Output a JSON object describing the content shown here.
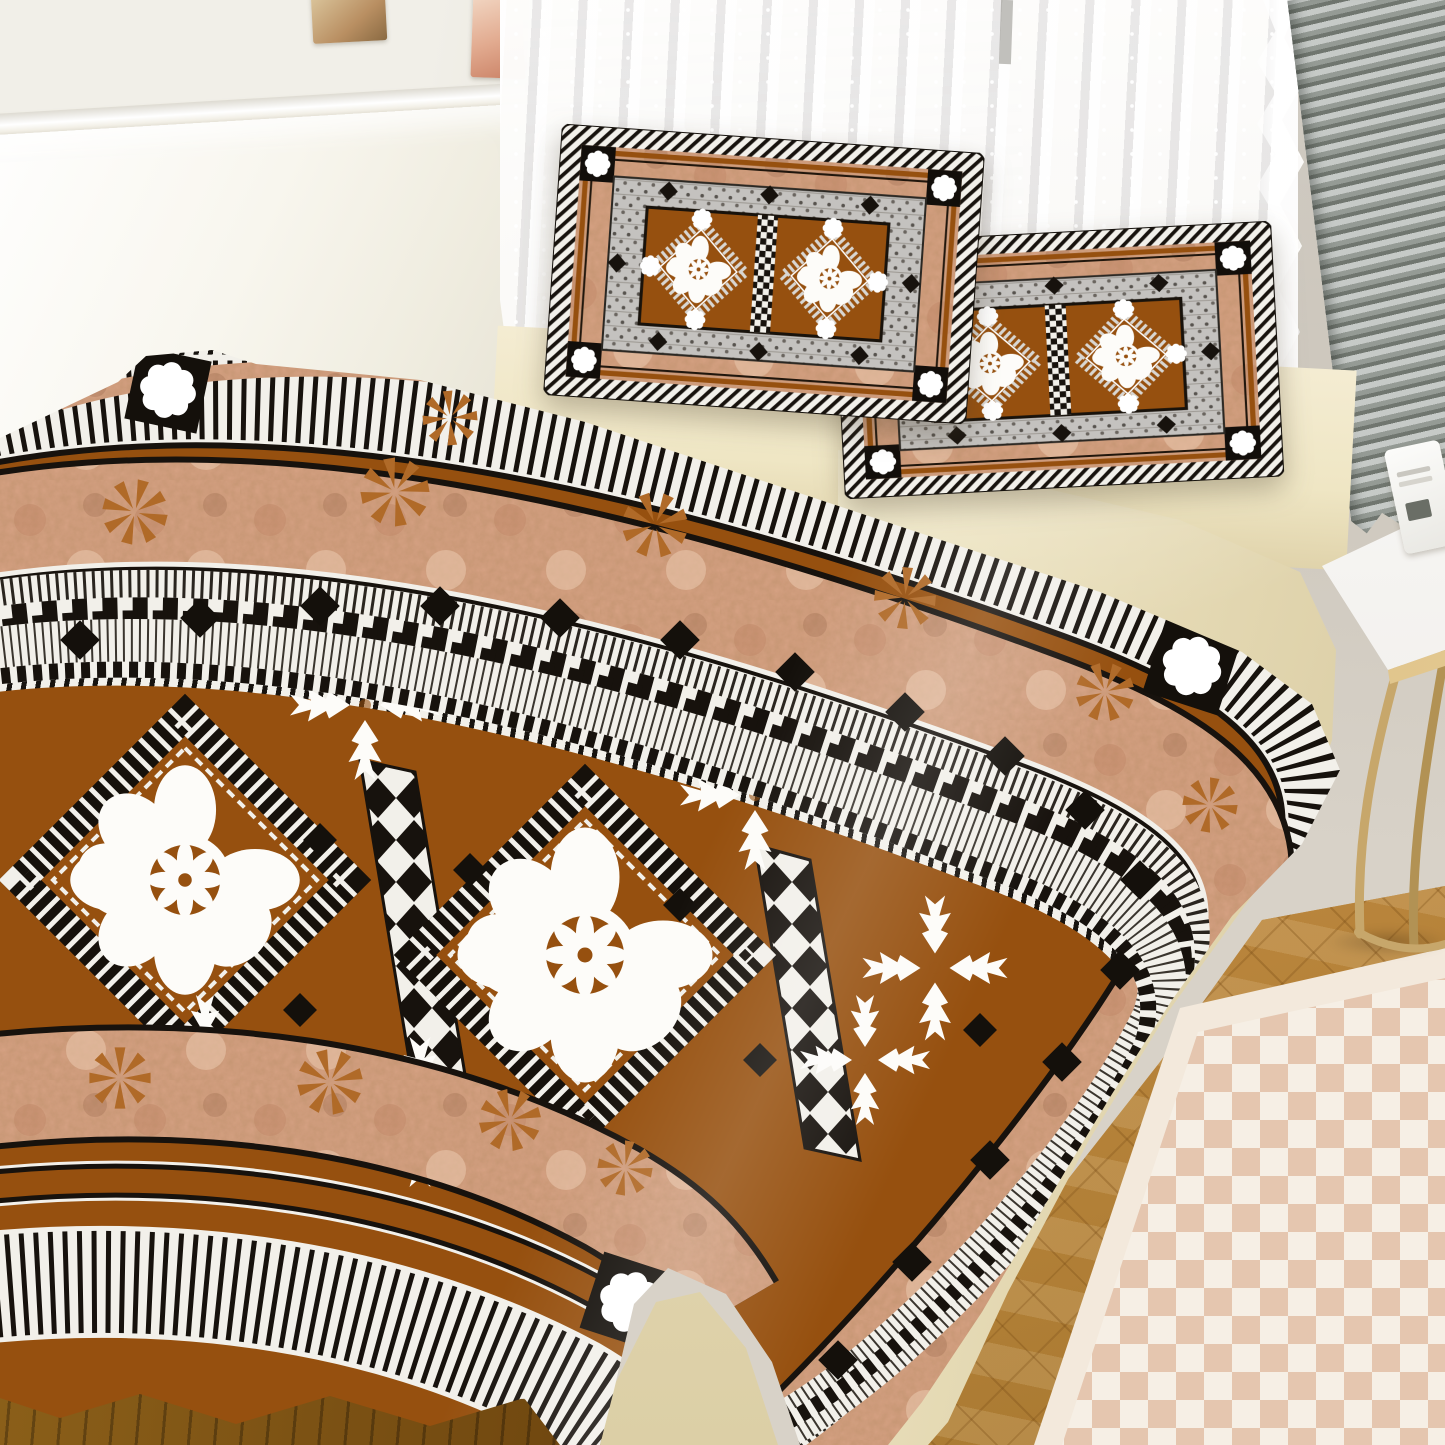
{
  "scene": {
    "type": "photograph",
    "description": "Bedroom product photo of a Fijian tapa-print bedding set: duvet cover and two matching pillowcases in brown, tan, black and white tribal pattern",
    "objects": {
      "wall_left": "white paneled wall with chair-rail molding",
      "photo_cards": "two small art cards pinned on wall",
      "window": "sheer lace curtain over venetian blinds",
      "pleated_blind": "grey pleated blind, top right corner",
      "pillow_left": "tapa-print pillowcase, rear left",
      "pillow_right": "tapa-print pillowcase, front right",
      "duvet": "tapa-print duvet with flower medallion diamonds and striped borders",
      "sheet": "cream bed sheet and mattress",
      "side_table": "white side table with brass legs and small white object",
      "floor": "light oak herringbone floor and dark wood floor corner",
      "rug": "pink and cream checkered rug"
    }
  },
  "colors": {
    "wall_left": "#f1efe8",
    "wainscot": "#f8f6ee",
    "wall_right": "#d8d2c8",
    "slat_dark": "#a9b0b2",
    "sheet": "#efe6c4",
    "brown": "#96500f",
    "dark": "#17120d",
    "white": "#f2f0ea",
    "tan": "#d6a183",
    "tan_dark": "#b97f5e",
    "pin": "#b06a28",
    "grey_band": "#c4c2bf",
    "wood": "#c79a55",
    "wood_dark": "#6e4610",
    "rug_base": "#f3e9dc",
    "rug_check": "#e5c6af",
    "gold": "#c7a76b"
  }
}
